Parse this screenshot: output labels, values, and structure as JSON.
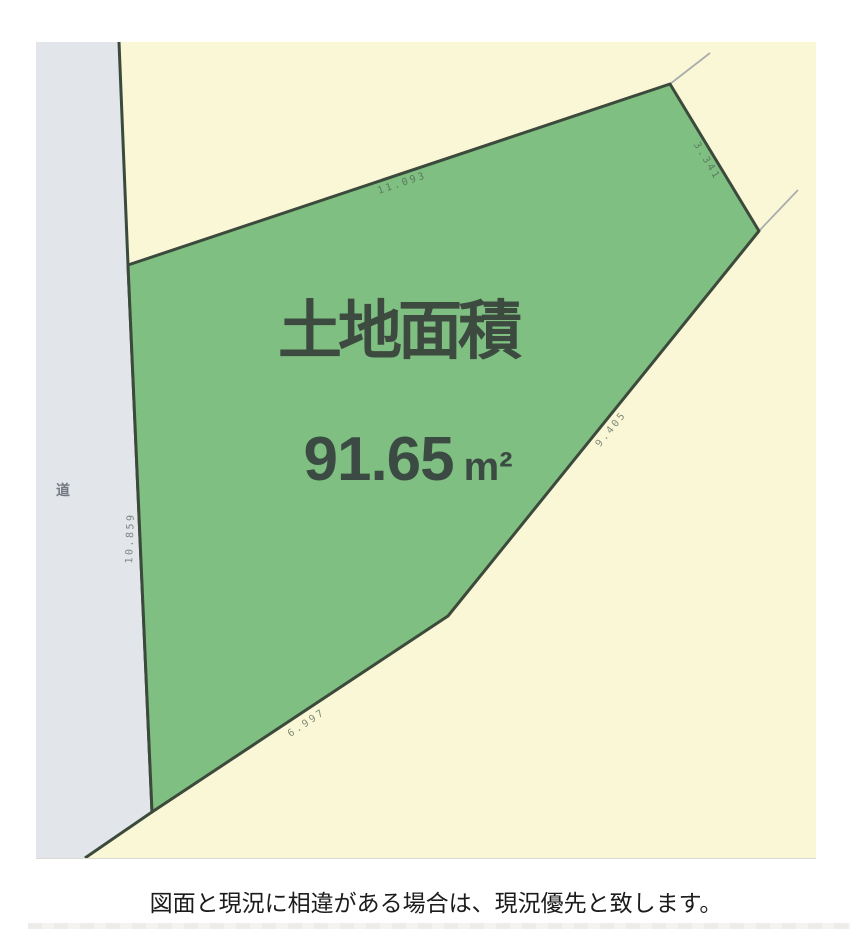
{
  "drawing": {
    "title": "土地面積",
    "area_value": "91.65",
    "area_unit": "m²",
    "road_label": "道",
    "edge_dimensions": {
      "top": "11.093",
      "upper_right": "3.341",
      "right": "9.405",
      "bottom": "6.997",
      "left": "10.859"
    },
    "colors": {
      "parcel_green": "#80bf82",
      "plan_cream": "#faf7d6",
      "road_gray": "#e2e5ea",
      "boundary_dark": "#3c4a3c",
      "survey_line_gray": "#a9aeac"
    }
  },
  "caption": "図面と現況に相違がある場合は、現況優先と致します。"
}
